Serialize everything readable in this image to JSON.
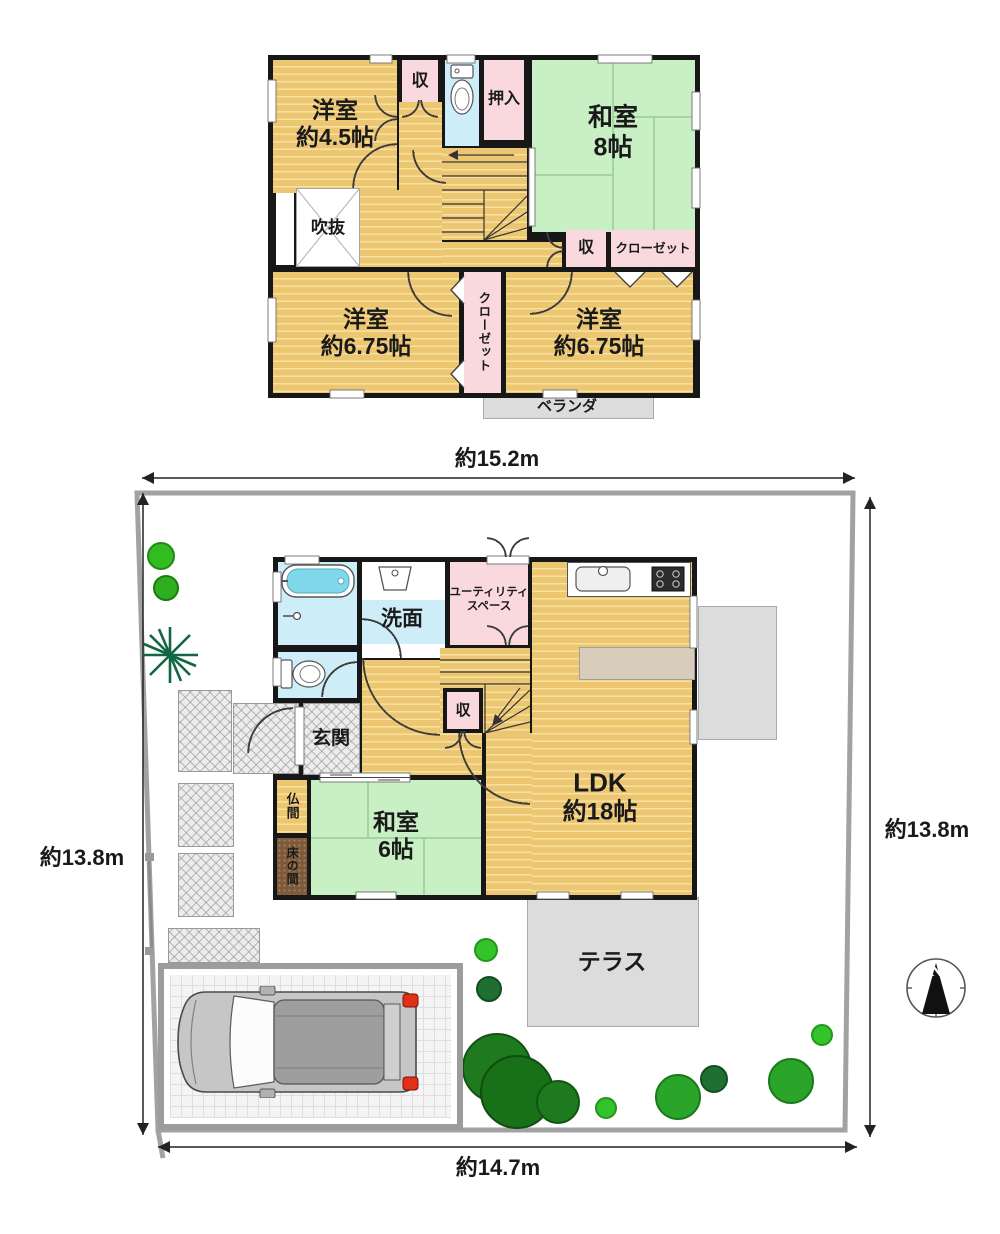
{
  "colors": {
    "wall": "#171717",
    "wood_floor": "#edc672",
    "tatami_green": "#c9efc5",
    "closet_pink": "#f9d9de",
    "bath_cyan": "#cdeef8",
    "terrace_gray": "#dcdcdc",
    "lot_boundary_gray": "#a2a2a2",
    "tree_bright_green": "#35c32c",
    "tree_dark_green": "#1b6b1b",
    "taillight_red": "#e23018"
  },
  "floor2": {
    "yoshitsu_nw": {
      "line1": "洋室",
      "line2": "約4.5帖"
    },
    "storage_top": "収",
    "oshiire": "押入",
    "washitsu": {
      "line1": "和室",
      "line2": "8帖"
    },
    "fukinuke": "吹抜",
    "storage_mid": "収",
    "closet": "クローゼット",
    "closet_vertical": "クローゼット",
    "yoshitsu_sw": {
      "line1": "洋室",
      "line2": "約6.75帖"
    },
    "yoshitsu_se": {
      "line1": "洋室",
      "line2": "約6.75帖"
    },
    "veranda": "ベランダ"
  },
  "floor1": {
    "senmen": "洗面",
    "utility": {
      "line1": "ユーティリティ",
      "line2": "スペース"
    },
    "genkan": "玄関",
    "storage": "収",
    "butsuma": "仏間",
    "tokonoma": "床の間",
    "washitsu": {
      "line1": "和室",
      "line2": "6帖"
    },
    "ldk": {
      "line1": "LDK",
      "line2": "約18帖"
    },
    "terrace": "テラス"
  },
  "site": {
    "dim_top": "約15.2m",
    "dim_bottom": "約14.7m",
    "dim_left": "約13.8m",
    "dim_right": "約13.8m",
    "north_label": "N"
  }
}
